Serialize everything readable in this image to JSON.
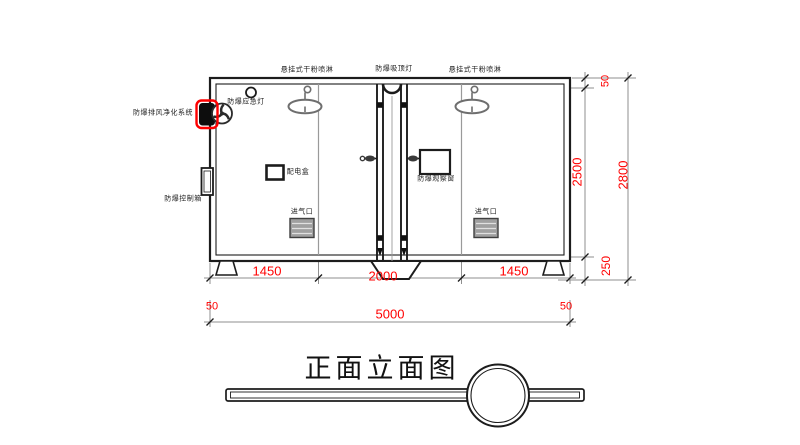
{
  "title": "正面立面图",
  "colors": {
    "dimension_text": "#ff0000",
    "highlight_outline": "#ff0000",
    "main_line": "#1c1c1c",
    "thin_line": "#8f8f8f",
    "sprinkler_gray": "#6e6e6e"
  },
  "equipment_labels": {
    "sprinkler_left": "悬挂式干粉喷淋",
    "ceiling_lamp": "防爆吸顶灯",
    "sprinkler_right": "悬挂式干粉喷淋",
    "emergency_light": "防爆应急灯",
    "purification_system": "防爆排风净化系统",
    "control_box": "防爆控制箱",
    "power_box": "配电盒",
    "observation_window": "防爆观察窗",
    "air_inlet_left": "进气口",
    "air_inlet_right": "进气口"
  },
  "dimensions": {
    "bottom_row": [
      "1450",
      "2000",
      "1450"
    ],
    "overall_width": "5000",
    "wall_left": "50",
    "wall_right": "50",
    "right_top": "50",
    "interior_height": "2500",
    "base_height": "250",
    "overall_height": "2800"
  }
}
